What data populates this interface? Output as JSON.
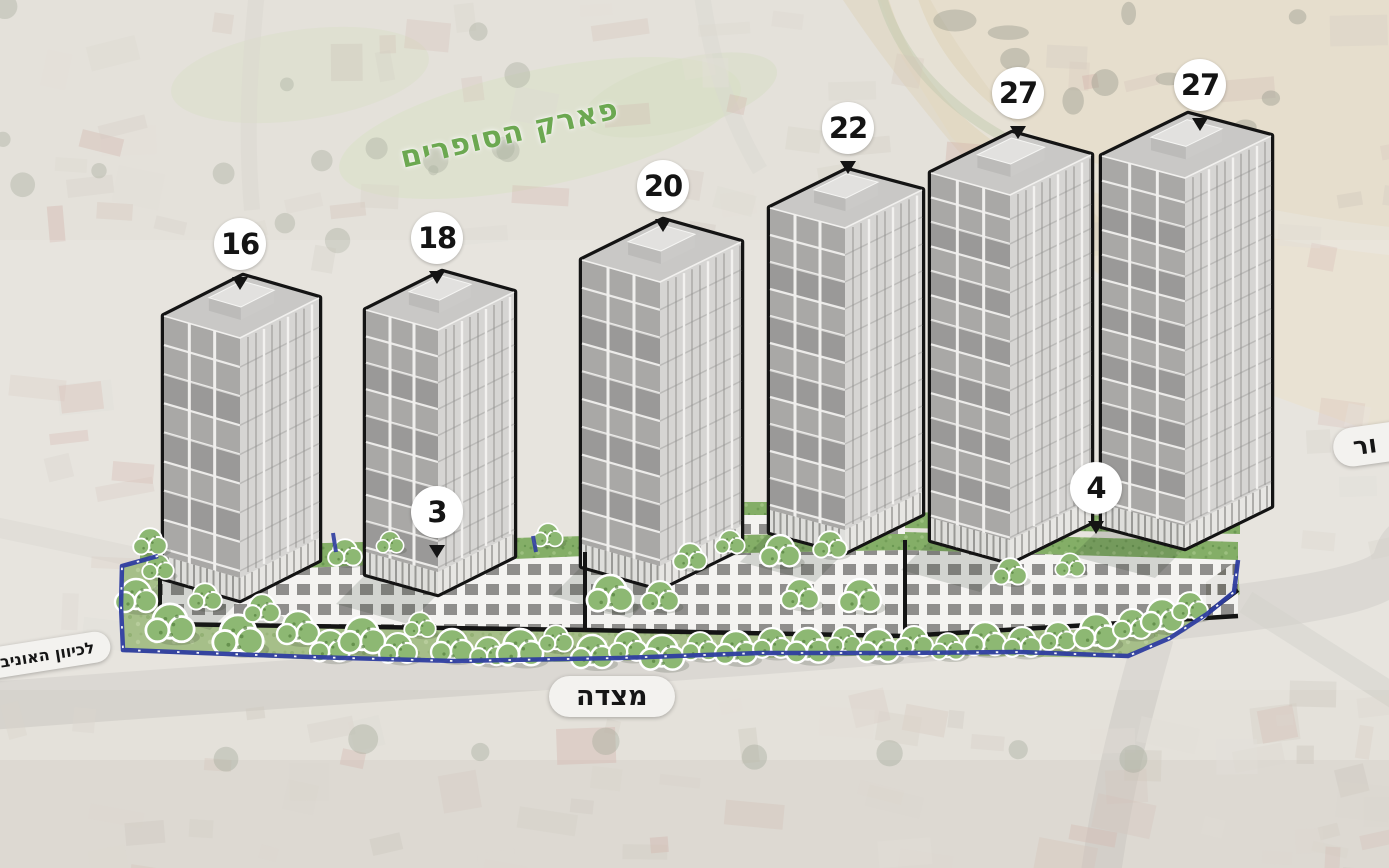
{
  "labels": {
    "park": "פארק הסופרים",
    "street": "מצדה",
    "direction_left": "לכיוון האוניבר",
    "street_right_partial": "ור"
  },
  "towers": [
    {
      "name": "tower-16",
      "floors": "16"
    },
    {
      "name": "tower-18",
      "floors": "18"
    },
    {
      "name": "tower-20",
      "floors": "20"
    },
    {
      "name": "tower-22",
      "floors": "22"
    },
    {
      "name": "tower-27-west",
      "floors": "27"
    },
    {
      "name": "tower-27-east",
      "floors": "27"
    }
  ],
  "podium_markers": [
    {
      "name": "podium-floors-3",
      "label": "3"
    },
    {
      "name": "podium-floors-4",
      "label": "4"
    }
  ],
  "colors": {
    "marker_bg": "#ffffff",
    "marker_text": "#141414",
    "outline_black": "#141414",
    "boundary_blue": "#2e3da0",
    "park_label_green": "#6ca851",
    "tree_green": "#8db873",
    "tree_dark": "#55803f",
    "roof_garden_green": "#84ae67",
    "lawn_green": "#a3bd85",
    "facade_panel": "#a9a8a6",
    "facade_light": "#d6d5d3",
    "podium_window": "#8f8e8c",
    "podium_frame": "#f4f3f1",
    "sand": "#decfb2",
    "pill_bg": "#f3f2ef"
  }
}
